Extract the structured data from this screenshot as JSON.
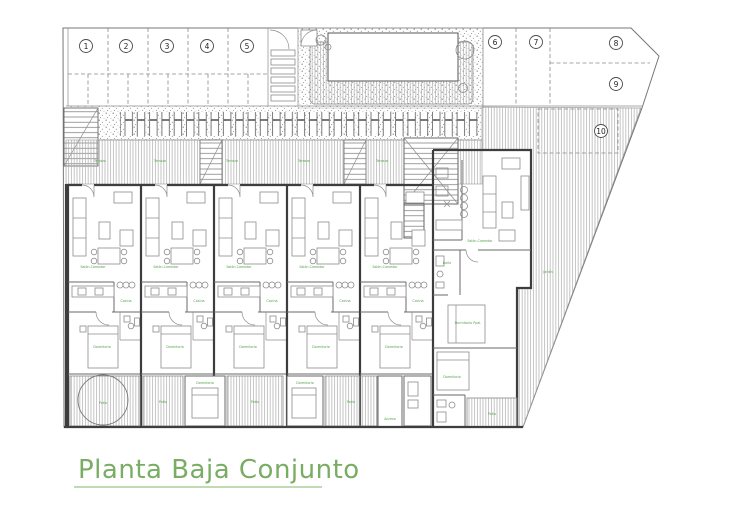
{
  "title": {
    "text": "Planta Baja Conjunto"
  },
  "parking": {
    "spots": [
      "1",
      "2",
      "3",
      "4",
      "5",
      "6",
      "7",
      "8",
      "9",
      "10"
    ]
  },
  "labels": {
    "terraza": "Terraza",
    "salon_comedor": "Salón-Comedor",
    "cocina": "Cocina",
    "dormitorio": "Dormitorio",
    "dormitorio_ppal": "Dormitorio Ppal.",
    "bano": "Baño",
    "patio": "Patio",
    "jardin": "Jardín",
    "acceso": "Acceso"
  },
  "colors": {
    "title_green": "#7aad64",
    "title_underline": "#9cc48b",
    "label_green": "#57a14e",
    "wall": "#3d3d3d",
    "hatch": "#adadad"
  }
}
